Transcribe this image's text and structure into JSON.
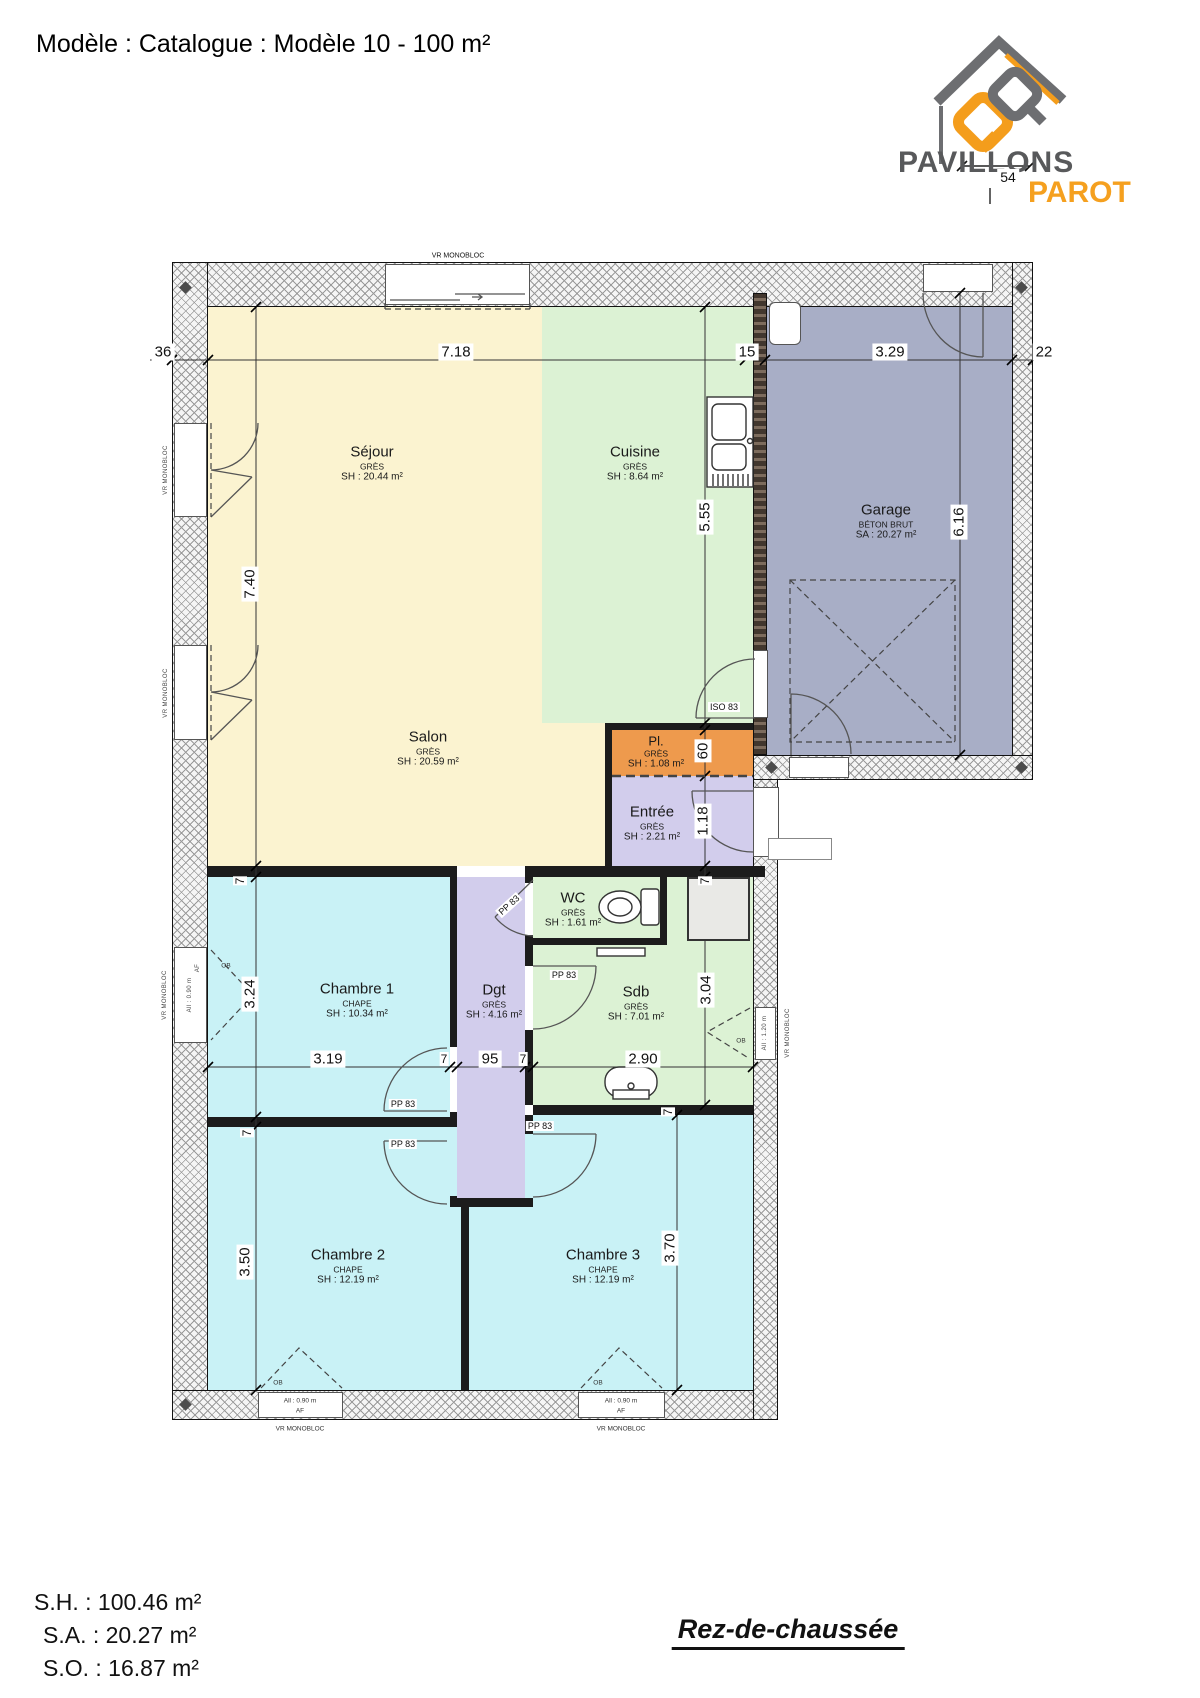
{
  "title": "Modèle : Catalogue : Modèle 10 - 100 m²",
  "logo": {
    "brand_line1": "PAVILLONS",
    "brand_line2": "PAROT",
    "dim_label": "54"
  },
  "rooms": {
    "sejour": {
      "name": "Séjour",
      "material": "GRÈS",
      "area": "SH : 20.44 m²"
    },
    "cuisine": {
      "name": "Cuisine",
      "material": "GRÈS",
      "area": "SH : 8.64 m²"
    },
    "garage": {
      "name": "Garage",
      "material": "BÉTON BRUT",
      "area": "SA : 20.27 m²"
    },
    "salon": {
      "name": "Salon",
      "material": "GRÈS",
      "area": "SH : 20.59 m²"
    },
    "pl": {
      "name": "Pl.",
      "material": "GRÈS",
      "area": "SH : 1.08 m²"
    },
    "entree": {
      "name": "Entrée",
      "material": "GRÈS",
      "area": "SH : 2.21 m²"
    },
    "wc": {
      "name": "WC",
      "material": "GRÈS",
      "area": "SH : 1.61 m²"
    },
    "dgt": {
      "name": "Dgt",
      "material": "GRÈS",
      "area": "SH : 4.16 m²"
    },
    "sdb": {
      "name": "Sdb",
      "material": "GRÈS",
      "area": "SH : 7.01 m²"
    },
    "ch1": {
      "name": "Chambre 1",
      "material": "CHAPE",
      "area": "SH : 10.34 m²"
    },
    "ch2": {
      "name": "Chambre 2",
      "material": "CHAPE",
      "area": "SH : 12.19 m²"
    },
    "ch3": {
      "name": "Chambre 3",
      "material": "CHAPE",
      "area": "SH : 12.19 m²"
    }
  },
  "dims": {
    "w36": "36",
    "m718": "7.18",
    "w15": "15",
    "m329": "3.29",
    "w22": "22",
    "m740": "7.40",
    "m324": "3.24",
    "m350": "3.50",
    "m555": "5.55",
    "m616": "6.16",
    "m60": "60",
    "m118": "1.18",
    "m304": "3.04",
    "m370": "3.70",
    "m319": "3.19",
    "m95": "95",
    "m290": "2.90",
    "w7": "7"
  },
  "labels": {
    "vr": "VR MONOBLOC",
    "iso83": "ISO 83",
    "pp83": "PP 83",
    "all090": "All : 0.90 m",
    "all120": "All : 1.20 m",
    "af": "AF",
    "ob": "OB"
  },
  "footer": {
    "sh": "S.H. : 100.46 m²",
    "sa": "S.A. : 20.27 m²",
    "so": "S.O. : 16.87 m²",
    "level": "Rez-de-chaussée"
  },
  "colors": {
    "sejour_salon": "#fbf3d0",
    "cuisine_sdb_wc": "#dcf2d4",
    "chambres": "#c9f2f6",
    "entree_dgt": "#d2cdec",
    "placard": "#ee9a4d",
    "garage": "#a8aec6",
    "walls": "#1c1c1c",
    "logo_gray": "#6d6e71",
    "logo_orange": "#f49d1c"
  }
}
